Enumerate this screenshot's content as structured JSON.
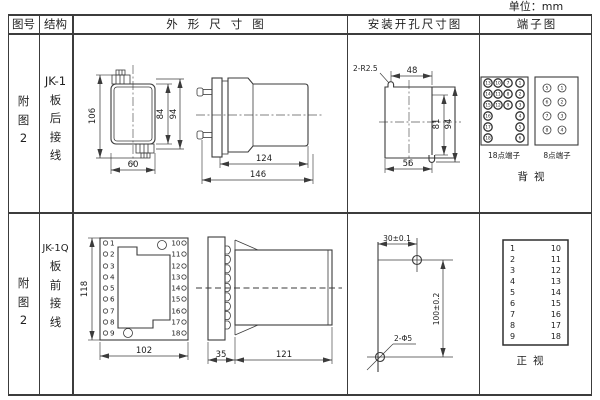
{
  "unit_label": "单位：mm",
  "headers": {
    "figure_no": "图号",
    "structure": "结构",
    "outline": "外形尺寸图",
    "install": "安装开孔尺寸图",
    "terminal": "端子图"
  },
  "row1": {
    "figure_no": [
      "附",
      "图",
      "2"
    ],
    "structure": [
      "JK-1",
      "板",
      "后",
      "接",
      "线"
    ],
    "front": {
      "h106": "106",
      "h84": "84",
      "h94": "94",
      "w60": "60"
    },
    "side": {
      "d124": "124",
      "d146": "146"
    },
    "install": {
      "radius_label": "2-R2.5",
      "w48": "48",
      "h81": "81",
      "h94": "94",
      "w56": "56"
    },
    "t18": {
      "label": "18点端子",
      "rows": [
        [
          "13",
          "10",
          "7",
          "1"
        ],
        [
          "14",
          "11",
          "8",
          "2"
        ],
        [
          "15",
          "12",
          "9",
          "3"
        ],
        [
          "16",
          "4"
        ],
        [
          "17",
          "5"
        ],
        [
          "18",
          "6"
        ]
      ]
    },
    "t8": {
      "label": "8点端子",
      "rows": [
        [
          "5",
          "1"
        ],
        [
          "6",
          "2"
        ],
        [
          "7",
          "3"
        ],
        [
          "8",
          "4"
        ]
      ]
    },
    "view_label": "背视"
  },
  "row2": {
    "figure_no": [
      "附",
      "图",
      "2"
    ],
    "structure": [
      "JK-1Q",
      "板",
      "前",
      "接",
      "线"
    ],
    "front": {
      "h118": "118",
      "w102": "102"
    },
    "side": {
      "d35": "35",
      "d121": "121"
    },
    "install": {
      "w30": "30±0.1",
      "h100": "100±0.2",
      "hole_label": "2-Φ5"
    },
    "term_left": [
      "1",
      "2",
      "3",
      "4",
      "5",
      "6",
      "7",
      "8",
      "9"
    ],
    "term_right": [
      "10",
      "11",
      "12",
      "13",
      "14",
      "15",
      "16",
      "17",
      "18"
    ],
    "view_label": "正视"
  }
}
